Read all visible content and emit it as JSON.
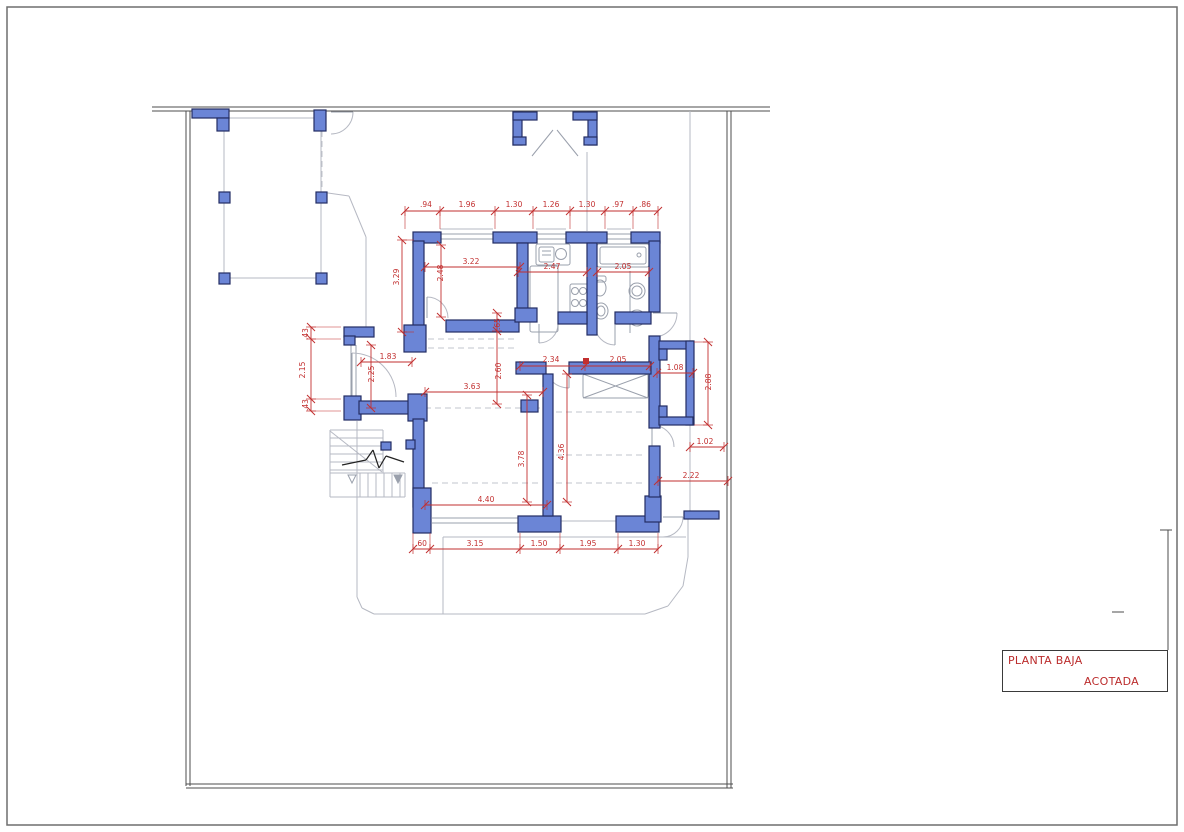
{
  "title_block": {
    "line1": "PLANTA BAJA",
    "line2": "ACOTADA"
  },
  "colors": {
    "wall_fill": "#6b85d6",
    "wall_stroke": "#232d63",
    "dim_red": "#c22f2f",
    "title_red": "#bb2c2c",
    "gray_light": "#b6b9c3",
    "gray_fixture": "#9aa0ac",
    "gray_dark": "#4d4d4d",
    "frame_gray": "#6e6e6e",
    "dash_gray": "#c2c5ce",
    "black": "#222222"
  },
  "plan": {
    "frame": [
      7,
      7,
      1170,
      818
    ],
    "boundary": [
      [
        152,
        107,
        770,
        107
      ],
      [
        152,
        111,
        770,
        111
      ],
      [
        186,
        111,
        186,
        786
      ],
      [
        190,
        111,
        190,
        786
      ],
      [
        186,
        784,
        733,
        784
      ],
      [
        186,
        788,
        733,
        788
      ],
      [
        727,
        111,
        727,
        788
      ],
      [
        731,
        111,
        731,
        788
      ],
      [
        1160,
        530,
        1172,
        530
      ],
      [
        1168,
        530,
        1168,
        650
      ],
      [
        1112,
        612,
        1124,
        612
      ]
    ],
    "gray_lines": [
      [
        224,
        118,
        321,
        118
      ],
      [
        321,
        118,
        321,
        278
      ],
      [
        224,
        278,
        321,
        278
      ],
      [
        224,
        118,
        224,
        278
      ],
      [
        321,
        192,
        349,
        196
      ],
      [
        349,
        196,
        366,
        237
      ],
      [
        366,
        237,
        366,
        327
      ],
      [
        357,
        421,
        357,
        597
      ],
      [
        357,
        597,
        362,
        608
      ],
      [
        362,
        608,
        374,
        614
      ],
      [
        374,
        614,
        645,
        614
      ],
      [
        645,
        614,
        668,
        606
      ],
      [
        668,
        606,
        683,
        586
      ],
      [
        683,
        586,
        688,
        557
      ],
      [
        688,
        557,
        688,
        516
      ],
      [
        443,
        537,
        686,
        537
      ],
      [
        443,
        537,
        443,
        614
      ],
      [
        690,
        111,
        690,
        511
      ],
      [
        587,
        152,
        587,
        231
      ],
      [
        440,
        229,
        493,
        229
      ],
      [
        536,
        229,
        566,
        229
      ],
      [
        607,
        229,
        631,
        229
      ],
      [
        560,
        521,
        616,
        521
      ],
      [
        330,
        430,
        383,
        430
      ],
      [
        330,
        430,
        330,
        497
      ],
      [
        330,
        497,
        405,
        497
      ],
      [
        405,
        473,
        405,
        497
      ],
      [
        383,
        430,
        383,
        473
      ],
      [
        330,
        473,
        405,
        473
      ],
      [
        330,
        438,
        383,
        438
      ],
      [
        330,
        446,
        383,
        446
      ],
      [
        330,
        454,
        383,
        454
      ],
      [
        330,
        462,
        383,
        462
      ],
      [
        330,
        470,
        383,
        470
      ],
      [
        330,
        431,
        382,
        472
      ],
      [
        360,
        473,
        360,
        497
      ],
      [
        368,
        473,
        368,
        497
      ],
      [
        376,
        473,
        376,
        497
      ],
      [
        384,
        473,
        384,
        497
      ],
      [
        392,
        473,
        392,
        497
      ],
      [
        400,
        473,
        400,
        497
      ]
    ],
    "dashed_lines": [
      [
        428,
        339,
        516,
        339
      ],
      [
        428,
        348,
        516,
        348
      ],
      [
        425,
        408,
        540,
        408
      ],
      [
        556,
        412,
        646,
        412
      ],
      [
        556,
        455,
        646,
        455
      ],
      [
        432,
        483,
        540,
        483
      ],
      [
        556,
        483,
        646,
        483
      ],
      [
        322,
        131,
        322,
        191
      ]
    ],
    "walls": [
      [
        413,
        232,
        28,
        11
      ],
      [
        493,
        232,
        44,
        11
      ],
      [
        566,
        232,
        41,
        11
      ],
      [
        631,
        232,
        29,
        11
      ],
      [
        413,
        241,
        11,
        86
      ],
      [
        404,
        325,
        22,
        27
      ],
      [
        344,
        327,
        30,
        10
      ],
      [
        344,
        336,
        11,
        9
      ],
      [
        344,
        396,
        17,
        24
      ],
      [
        359,
        401,
        52,
        13
      ],
      [
        408,
        394,
        19,
        27
      ],
      [
        413,
        419,
        11,
        88
      ],
      [
        413,
        488,
        18,
        45
      ],
      [
        518,
        516,
        43,
        16
      ],
      [
        616,
        516,
        43,
        16
      ],
      [
        645,
        496,
        16,
        26
      ],
      [
        684,
        511,
        35,
        8
      ],
      [
        649,
        241,
        11,
        71
      ],
      [
        649,
        336,
        11,
        92
      ],
      [
        649,
        446,
        11,
        51
      ],
      [
        659,
        341,
        34,
        8
      ],
      [
        686,
        341,
        8,
        84
      ],
      [
        659,
        417,
        34,
        8
      ],
      [
        659,
        349,
        8,
        11
      ],
      [
        659,
        406,
        8,
        11
      ],
      [
        446,
        320,
        73,
        12
      ],
      [
        517,
        243,
        11,
        67
      ],
      [
        515,
        308,
        22,
        14
      ],
      [
        587,
        243,
        10,
        92
      ],
      [
        558,
        312,
        29,
        12
      ],
      [
        615,
        312,
        36,
        12
      ],
      [
        516,
        362,
        30,
        12
      ],
      [
        569,
        362,
        82,
        12
      ],
      [
        543,
        374,
        10,
        142
      ],
      [
        521,
        400,
        17,
        12
      ],
      [
        513,
        112,
        9,
        33
      ],
      [
        588,
        112,
        9,
        33
      ],
      [
        513,
        112,
        24,
        8
      ],
      [
        573,
        112,
        24,
        8
      ],
      [
        513,
        137,
        13,
        8
      ],
      [
        584,
        137,
        13,
        8
      ],
      [
        192,
        109,
        37,
        9
      ],
      [
        217,
        118,
        12,
        13
      ],
      [
        314,
        110,
        12,
        21
      ],
      [
        219,
        192,
        11,
        11
      ],
      [
        316,
        192,
        11,
        11
      ],
      [
        219,
        273,
        11,
        11
      ],
      [
        316,
        273,
        11,
        11
      ],
      [
        381,
        442,
        10,
        8
      ],
      [
        406,
        440,
        9,
        9
      ]
    ],
    "window_pairs": [
      [
        440,
        234,
        53,
        "h"
      ],
      [
        536,
        234,
        30,
        "h"
      ],
      [
        607,
        234,
        24,
        "h"
      ],
      [
        351,
        345,
        52,
        "v"
      ],
      [
        432,
        518,
        86,
        "h"
      ]
    ],
    "door_arcs": [
      [
        427,
        318,
        21,
        -90,
        0
      ],
      [
        539,
        324,
        19,
        0,
        90
      ],
      [
        615,
        325,
        20,
        90,
        180
      ],
      [
        653,
        313,
        24,
        0,
        90
      ],
      [
        652,
        447,
        22,
        -90,
        0
      ],
      [
        663,
        517,
        20,
        0,
        90
      ],
      [
        352,
        397,
        44,
        -90,
        0
      ],
      [
        569,
        363,
        25,
        90,
        180
      ],
      [
        331,
        112,
        22,
        0,
        90
      ]
    ],
    "door_leaves": [
      [
        427,
        318,
        427,
        297
      ],
      [
        539,
        324,
        539,
        343
      ],
      [
        615,
        325,
        615,
        345
      ],
      [
        653,
        313,
        677,
        313
      ],
      [
        652,
        447,
        652,
        425
      ],
      [
        663,
        517,
        683,
        517
      ],
      [
        352,
        397,
        352,
        353
      ],
      [
        569,
        363,
        569,
        388
      ],
      [
        331,
        112,
        353,
        112
      ],
      [
        532,
        156,
        553,
        130
      ],
      [
        578,
        156,
        557,
        130
      ]
    ],
    "fixture_rects": [
      [
        536,
        244,
        34,
        21
      ],
      [
        539,
        247,
        15,
        15
      ],
      [
        530,
        266,
        28,
        66
      ],
      [
        570,
        284,
        19,
        30
      ],
      [
        597,
        244,
        52,
        23
      ],
      [
        600,
        247,
        46,
        17
      ],
      [
        593,
        276,
        13,
        6
      ],
      [
        583,
        374,
        65,
        24
      ]
    ],
    "fixture_circles": [
      [
        575,
        291,
        3.5
      ],
      [
        583,
        291,
        3.5
      ],
      [
        575,
        303,
        3.5
      ],
      [
        583,
        303,
        3.5
      ],
      [
        639,
        255,
        2
      ],
      [
        561,
        254,
        5.5
      ],
      [
        637,
        291,
        8
      ],
      [
        637,
        291,
        5
      ],
      [
        637,
        318,
        8
      ],
      [
        637,
        318,
        5
      ]
    ],
    "fixture_ellipses": [
      [
        600,
        288,
        6,
        8
      ],
      [
        601,
        311,
        7,
        8
      ],
      [
        601,
        311,
        4,
        5
      ]
    ],
    "fixture_lines": [
      [
        542,
        251,
        551,
        251
      ],
      [
        542,
        255,
        551,
        255
      ],
      [
        630,
        271,
        630,
        333
      ],
      [
        583,
        374,
        648,
        398
      ],
      [
        583,
        398,
        648,
        374
      ]
    ],
    "black_lines": [
      [
        342,
        465,
        366,
        460
      ],
      [
        366,
        460,
        373,
        450
      ],
      [
        373,
        450,
        379,
        468
      ],
      [
        379,
        468,
        386,
        456
      ],
      [
        386,
        456,
        404,
        462
      ]
    ],
    "triangles": [
      {
        "pts": "348,475 356,475 352,483",
        "fill": false
      },
      {
        "pts": "394,475 402,475 398,483",
        "fill": true
      }
    ],
    "red_squares": [
      [
        583,
        358,
        6
      ]
    ],
    "dim_chains": [
      {
        "o": "h",
        "c": 211,
        "pts": [
          405,
          440,
          495,
          533,
          570,
          605,
          633,
          658
        ],
        "ext": 18
      },
      {
        "o": "h",
        "c": 267,
        "pts": [
          425,
          520
        ],
        "ext": 0
      },
      {
        "o": "h",
        "c": 272,
        "pts": [
          518,
          587
        ],
        "ext": 0
      },
      {
        "o": "h",
        "c": 272,
        "pts": [
          597,
          649
        ],
        "ext": 0
      },
      {
        "o": "h",
        "c": 362,
        "pts": [
          361,
          412
        ],
        "ext": 0
      },
      {
        "o": "h",
        "c": 392,
        "pts": [
          425,
          543
        ],
        "ext": 0
      },
      {
        "o": "h",
        "c": 366,
        "pts": [
          520,
          585,
          650
        ],
        "ext": 0
      },
      {
        "o": "h",
        "c": 373,
        "pts": [
          657,
          693
        ],
        "ext": 0
      },
      {
        "o": "h",
        "c": 447,
        "pts": [
          690,
          724
        ],
        "ext": 0
      },
      {
        "o": "h",
        "c": 481,
        "pts": [
          658,
          728
        ],
        "ext": 0
      },
      {
        "o": "h",
        "c": 505,
        "pts": [
          425,
          547
        ],
        "ext": 0
      },
      {
        "o": "h",
        "c": 549,
        "pts": [
          413,
          430,
          520,
          560,
          618,
          658
        ],
        "ext": -16
      },
      {
        "o": "v",
        "c": 402,
        "pts": [
          240,
          332
        ],
        "ext": 12
      },
      {
        "o": "v",
        "c": 441,
        "pts": [
          245,
          317
        ],
        "ext": 0
      },
      {
        "o": "v",
        "c": 311,
        "pts": [
          327,
          339,
          399,
          411
        ],
        "ext": 30
      },
      {
        "o": "v",
        "c": 371,
        "pts": [
          345,
          408
        ],
        "ext": 0
      },
      {
        "o": "v",
        "c": 497,
        "pts": [
          313,
          331,
          404
        ],
        "ext": 0
      },
      {
        "o": "v",
        "c": 527,
        "pts": [
          395,
          502
        ],
        "ext": 0
      },
      {
        "o": "v",
        "c": 567,
        "pts": [
          374,
          502
        ],
        "ext": 0
      },
      {
        "o": "v",
        "c": 708,
        "pts": [
          342,
          425
        ],
        "ext": -14
      }
    ],
    "dim_labels": [
      {
        "t": ".94",
        "x": 426,
        "y": 207,
        "r": 0
      },
      {
        "t": "1.96",
        "x": 467,
        "y": 207,
        "r": 0
      },
      {
        "t": "1.30",
        "x": 514,
        "y": 207,
        "r": 0
      },
      {
        "t": "1.26",
        "x": 551,
        "y": 207,
        "r": 0
      },
      {
        "t": "1.30",
        "x": 587,
        "y": 207,
        "r": 0
      },
      {
        "t": ".97",
        "x": 618,
        "y": 207,
        "r": 0
      },
      {
        "t": ".86",
        "x": 645,
        "y": 207,
        "r": 0
      },
      {
        "t": "3.22",
        "x": 471,
        "y": 264,
        "r": 0
      },
      {
        "t": "2.47",
        "x": 552,
        "y": 269,
        "r": 0
      },
      {
        "t": "2.05",
        "x": 623,
        "y": 269,
        "r": 0
      },
      {
        "t": "3.29",
        "x": 399,
        "y": 277,
        "r": 1
      },
      {
        "t": "2.48",
        "x": 443,
        "y": 273,
        "r": 1
      },
      {
        "t": ".43",
        "x": 308,
        "y": 334,
        "r": 1
      },
      {
        "t": "2.15",
        "x": 305,
        "y": 370,
        "r": 1
      },
      {
        "t": ".43",
        "x": 308,
        "y": 405,
        "r": 1
      },
      {
        "t": "2.25",
        "x": 374,
        "y": 374,
        "r": 1
      },
      {
        "t": "1.83",
        "x": 388,
        "y": 359,
        "r": 0
      },
      {
        "t": ".65",
        "x": 500,
        "y": 324,
        "r": 1
      },
      {
        "t": "2.60",
        "x": 501,
        "y": 371,
        "r": 1
      },
      {
        "t": "3.63",
        "x": 472,
        "y": 389,
        "r": 0
      },
      {
        "t": "2.34",
        "x": 551,
        "y": 362,
        "r": 0
      },
      {
        "t": "2.05",
        "x": 618,
        "y": 362,
        "r": 0
      },
      {
        "t": "1.08",
        "x": 675,
        "y": 370,
        "r": 0
      },
      {
        "t": "2.88",
        "x": 711,
        "y": 382,
        "r": 1
      },
      {
        "t": "1.02",
        "x": 705,
        "y": 444,
        "r": 0
      },
      {
        "t": "2.22",
        "x": 691,
        "y": 478,
        "r": 0
      },
      {
        "t": "3.78",
        "x": 524,
        "y": 459,
        "r": 1
      },
      {
        "t": "4.36",
        "x": 564,
        "y": 452,
        "r": 1
      },
      {
        "t": "4.40",
        "x": 486,
        "y": 502,
        "r": 0
      },
      {
        "t": ".60",
        "x": 421,
        "y": 546,
        "r": 0
      },
      {
        "t": "3.15",
        "x": 475,
        "y": 546,
        "r": 0
      },
      {
        "t": "1.50",
        "x": 539,
        "y": 546,
        "r": 0
      },
      {
        "t": "1.95",
        "x": 588,
        "y": 546,
        "r": 0
      },
      {
        "t": "1.30",
        "x": 637,
        "y": 546,
        "r": 0
      }
    ]
  }
}
